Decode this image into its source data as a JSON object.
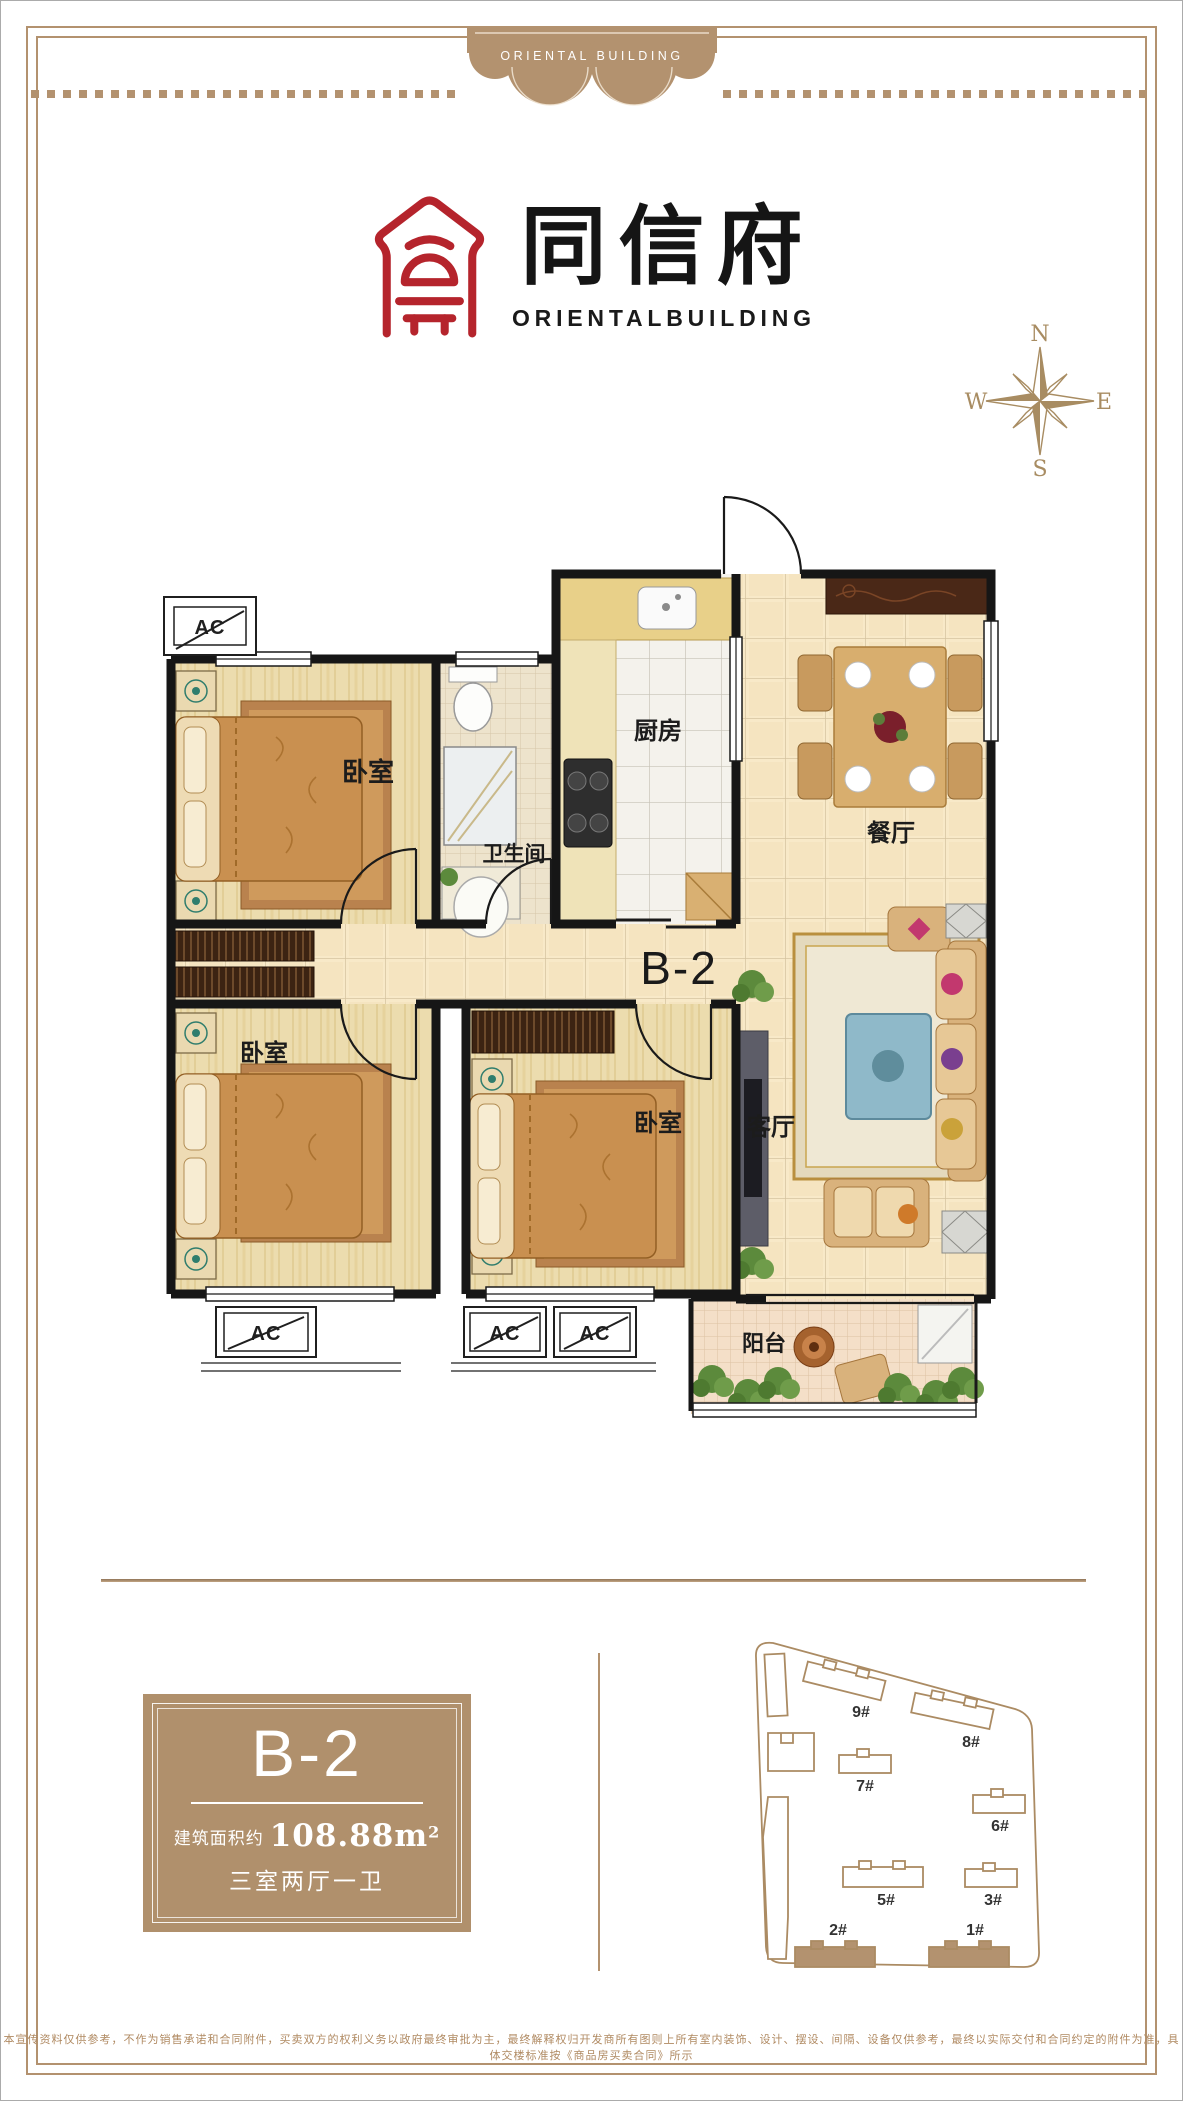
{
  "banner": {
    "text": "ORIENTAL BUILDING"
  },
  "brand": {
    "title": "同信府",
    "subtitle": "ORIENTALBUILDING"
  },
  "compass": {
    "n": "N",
    "e": "E",
    "s": "S",
    "w": "W"
  },
  "floorplan": {
    "unit_label": "B-2",
    "ac_label": "AC",
    "rooms": {
      "bedroom1": "卧室",
      "bathroom": "卫生间",
      "kitchen": "厨房",
      "dining": "餐厅",
      "bedroom2": "卧室",
      "bedroom3": "卧室",
      "living": "客厅",
      "balcony": "阳台"
    }
  },
  "info_card": {
    "unit": "B-2",
    "area_prefix": "建筑面积约",
    "area_value": "108.88m",
    "area_sup": "2",
    "layout": "三室两厅一卫"
  },
  "siteplan": {
    "buildings": [
      {
        "label": "9#",
        "highlighted": false
      },
      {
        "label": "8#",
        "highlighted": false
      },
      {
        "label": "7#",
        "highlighted": false
      },
      {
        "label": "6#",
        "highlighted": false
      },
      {
        "label": "5#",
        "highlighted": false
      },
      {
        "label": "3#",
        "highlighted": false
      },
      {
        "label": "2#",
        "highlighted": true
      },
      {
        "label": "1#",
        "highlighted": true
      }
    ]
  },
  "footer": {
    "disclaimer": "本宣传资料仅供参考，不作为销售承诺和合同附件，买卖双方的权利义务以政府最终审批为主，最终解释权归开发商所有图则上所有室内装饰、设计、摆设、间隔、设备仅供参考，最终以实际交付和合同约定的附件为准，具体交楼标准按《商品房买卖合同》所示"
  },
  "colors": {
    "accent": "#b3926f",
    "logo_red": "#b5242c",
    "text_dark": "#1e1e1e",
    "card_bg": "#b0906c"
  }
}
